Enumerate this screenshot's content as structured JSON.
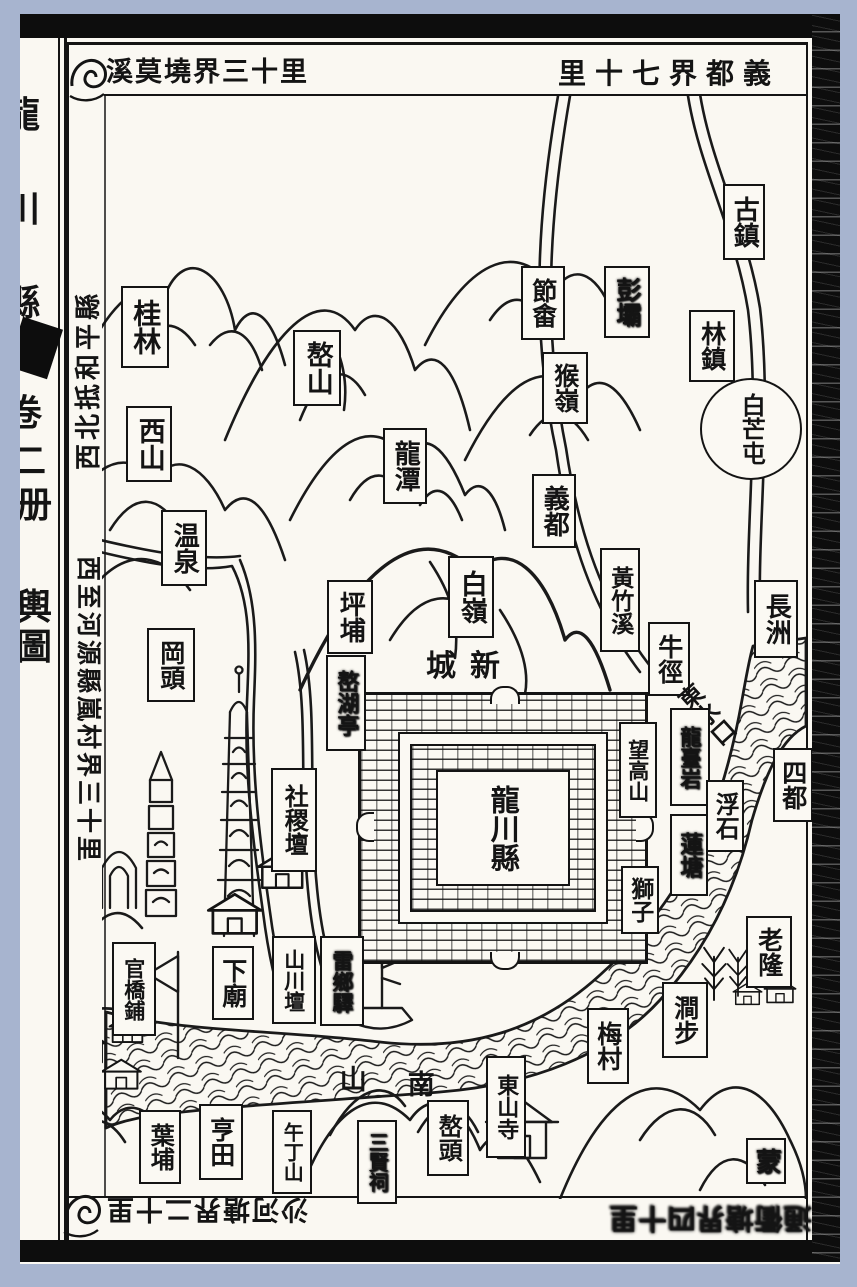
{
  "palette": {
    "page_bg": "#a7b4cf",
    "paper": "#faf8f2",
    "ink": "#141414"
  },
  "spine": {
    "chars": [
      {
        "id": "long",
        "ch": "龍",
        "y": 48,
        "x": -16
      },
      {
        "id": "chuan",
        "ch": "川",
        "y": 142,
        "x": -16
      },
      {
        "id": "xian",
        "ch": "縣",
        "y": 236,
        "x": -16
      },
      {
        "id": "juan",
        "ch": "卷",
        "y": 346,
        "x": -14
      },
      {
        "id": "er",
        "ch": "二",
        "y": 394,
        "x": -10
      },
      {
        "id": "ce",
        "ch": "册",
        "y": 438,
        "x": -4
      },
      {
        "id": "yu",
        "ch": "輿",
        "y": 540,
        "x": -4
      },
      {
        "id": "tu",
        "ch": "圖",
        "y": 580,
        "x": -4
      }
    ]
  },
  "margins": {
    "top_left": "溪莫墝界三十里",
    "top_right": "里十七界都義",
    "left_top": "西北抵和平縣",
    "left_bottom": "西至河源縣嵐村界三十里",
    "bottom_left": "沙河塘界二十里",
    "bottom_right": "通衢塘界四十里"
  },
  "city": {
    "name_label": "龍川縣",
    "new_city_label": "城新"
  },
  "map_labels": [
    {
      "id": "guilin",
      "text": "桂林",
      "x": 121,
      "y": 286,
      "w": 44,
      "h": 78,
      "fs": 28,
      "shape": "box"
    },
    {
      "id": "xishan",
      "text": "西山",
      "x": 126,
      "y": 406,
      "w": 42,
      "h": 72,
      "fs": 27,
      "shape": "box"
    },
    {
      "id": "aoshan",
      "text": "嶅山",
      "x": 293,
      "y": 330,
      "w": 44,
      "h": 72,
      "fs": 27,
      "shape": "box"
    },
    {
      "id": "longtan",
      "text": "龍潭",
      "x": 383,
      "y": 428,
      "w": 40,
      "h": 72,
      "fs": 26,
      "shape": "box"
    },
    {
      "id": "jieshe",
      "text": "節畬",
      "x": 521,
      "y": 266,
      "w": 40,
      "h": 70,
      "fs": 25,
      "shape": "box"
    },
    {
      "id": "pengba",
      "text": "彭壩",
      "x": 604,
      "y": 266,
      "w": 42,
      "h": 68,
      "fs": 25,
      "shape": "smudge"
    },
    {
      "id": "houling",
      "text": "猴嶺",
      "x": 542,
      "y": 352,
      "w": 42,
      "h": 68,
      "fs": 25,
      "shape": "box"
    },
    {
      "id": "guzhen",
      "text": "古鎮",
      "x": 723,
      "y": 184,
      "w": 38,
      "h": 72,
      "fs": 26,
      "shape": "box"
    },
    {
      "id": "linzhen",
      "text": "林鎮",
      "x": 689,
      "y": 310,
      "w": 42,
      "h": 68,
      "fs": 25,
      "shape": "box"
    },
    {
      "id": "baimangtun",
      "text": "白芒屯",
      "x": 700,
      "y": 378,
      "w": 98,
      "h": 98,
      "fs": 24,
      "shape": "circle"
    },
    {
      "id": "yidu",
      "text": "義都",
      "x": 532,
      "y": 474,
      "w": 40,
      "h": 70,
      "fs": 26,
      "shape": "box"
    },
    {
      "id": "huangzhuxi",
      "text": "黃竹溪",
      "x": 600,
      "y": 548,
      "w": 36,
      "h": 100,
      "fs": 23,
      "shape": "box"
    },
    {
      "id": "changzhou",
      "text": "長洲",
      "x": 754,
      "y": 580,
      "w": 40,
      "h": 74,
      "fs": 26,
      "shape": "box"
    },
    {
      "id": "wenquan",
      "text": "温泉",
      "x": 161,
      "y": 510,
      "w": 42,
      "h": 72,
      "fs": 26,
      "shape": "box"
    },
    {
      "id": "gangtou",
      "text": "岡頭",
      "x": 147,
      "y": 628,
      "w": 44,
      "h": 70,
      "fs": 25,
      "shape": "box"
    },
    {
      "id": "pingbu",
      "text": "坪埔",
      "x": 327,
      "y": 580,
      "w": 42,
      "h": 70,
      "fs": 26,
      "shape": "box"
    },
    {
      "id": "bailing",
      "text": "白嶺",
      "x": 448,
      "y": 556,
      "w": 42,
      "h": 78,
      "fs": 27,
      "shape": "box"
    },
    {
      "id": "aohuting",
      "text": "嶅湖亭",
      "x": 326,
      "y": 655,
      "w": 36,
      "h": 92,
      "fs": 22,
      "shape": "smudge"
    },
    {
      "id": "niujing",
      "text": "牛徑",
      "x": 648,
      "y": 622,
      "w": 38,
      "h": 70,
      "fs": 25,
      "shape": "box"
    },
    {
      "id": "wanggaoshan",
      "text": "望高山",
      "x": 619,
      "y": 722,
      "w": 34,
      "h": 92,
      "fs": 21,
      "shape": "box"
    },
    {
      "id": "dongshuikou",
      "text": "東水口",
      "x": 688,
      "y": 666,
      "w": 34,
      "h": 100,
      "fs": 24,
      "shape": "plain",
      "rot": -42
    },
    {
      "id": "longtaiyan",
      "text": "龍臺岩",
      "x": 670,
      "y": 708,
      "w": 36,
      "h": 94,
      "fs": 21,
      "shape": "smudge"
    },
    {
      "id": "sidu",
      "text": "四都",
      "x": 773,
      "y": 748,
      "w": 36,
      "h": 70,
      "fs": 25,
      "shape": "box"
    },
    {
      "id": "fushi",
      "text": "浮石",
      "x": 706,
      "y": 780,
      "w": 34,
      "h": 68,
      "fs": 24,
      "shape": "box"
    },
    {
      "id": "liantang",
      "text": "蓮塘",
      "x": 670,
      "y": 814,
      "w": 34,
      "h": 78,
      "fs": 23,
      "shape": "smudge"
    },
    {
      "id": "shizi",
      "text": "獅子",
      "x": 621,
      "y": 866,
      "w": 34,
      "h": 64,
      "fs": 23,
      "shape": "box"
    },
    {
      "id": "shejitan",
      "text": "社稷壇",
      "x": 271,
      "y": 768,
      "w": 42,
      "h": 100,
      "fs": 24,
      "shape": "box"
    },
    {
      "id": "xincheng",
      "text": "城新",
      "x": 420,
      "y": 648,
      "w": 100,
      "h": 38,
      "fs": 30,
      "shape": "hplain"
    },
    {
      "id": "xiamiao",
      "text": "下廟",
      "x": 212,
      "y": 946,
      "w": 38,
      "h": 70,
      "fs": 25,
      "shape": "box"
    },
    {
      "id": "shanchuantan",
      "text": "山川壇",
      "x": 272,
      "y": 936,
      "w": 40,
      "h": 84,
      "fs": 21,
      "shape": "box"
    },
    {
      "id": "leixiangyi",
      "text": "雷鄉驛",
      "x": 320,
      "y": 936,
      "w": 40,
      "h": 86,
      "fs": 21,
      "shape": "smudge"
    },
    {
      "id": "guanqiaopu",
      "text": "官橋鋪",
      "x": 112,
      "y": 942,
      "w": 40,
      "h": 90,
      "fs": 21,
      "shape": "box"
    },
    {
      "id": "yepu",
      "text": "葉埔",
      "x": 139,
      "y": 1110,
      "w": 38,
      "h": 70,
      "fs": 24,
      "shape": "box"
    },
    {
      "id": "hengtian",
      "text": "亨田",
      "x": 199,
      "y": 1104,
      "w": 40,
      "h": 72,
      "fs": 25,
      "shape": "box"
    },
    {
      "id": "wudingshan",
      "text": "午丁山",
      "x": 272,
      "y": 1110,
      "w": 36,
      "h": 80,
      "fs": 20,
      "shape": "box"
    },
    {
      "id": "sanxianci",
      "text": "三賢祠",
      "x": 357,
      "y": 1120,
      "w": 36,
      "h": 80,
      "fs": 20,
      "shape": "smudge"
    },
    {
      "id": "shan-char",
      "text": "山",
      "x": 336,
      "y": 1062,
      "w": 28,
      "h": 32,
      "fs": 27,
      "shape": "plain"
    },
    {
      "id": "nan-char",
      "text": "南",
      "x": 404,
      "y": 1066,
      "w": 28,
      "h": 34,
      "fs": 27,
      "shape": "plain"
    },
    {
      "id": "aotou",
      "text": "嶅頭",
      "x": 427,
      "y": 1100,
      "w": 38,
      "h": 72,
      "fs": 24,
      "shape": "box"
    },
    {
      "id": "dongshansi",
      "text": "東山寺",
      "x": 486,
      "y": 1056,
      "w": 36,
      "h": 98,
      "fs": 22,
      "shape": "box"
    },
    {
      "id": "meicun",
      "text": "梅村",
      "x": 587,
      "y": 1008,
      "w": 38,
      "h": 72,
      "fs": 25,
      "shape": "box"
    },
    {
      "id": "jianbu",
      "text": "澗步",
      "x": 662,
      "y": 982,
      "w": 42,
      "h": 72,
      "fs": 25,
      "shape": "box"
    },
    {
      "id": "laolong",
      "text": "老隆",
      "x": 746,
      "y": 916,
      "w": 42,
      "h": 68,
      "fs": 25,
      "shape": "box"
    },
    {
      "id": "meng",
      "text": "蒙",
      "x": 746,
      "y": 1138,
      "w": 36,
      "h": 42,
      "fs": 26,
      "shape": "smudge"
    }
  ],
  "icons": [
    "water-swirl-icon",
    "pagoda-icon",
    "stacked-tower-icon",
    "shrine-arch-icon",
    "house-icon",
    "temple-icon",
    "boat-icon",
    "flag-icon",
    "tree-icon",
    "city-gate-icon"
  ]
}
